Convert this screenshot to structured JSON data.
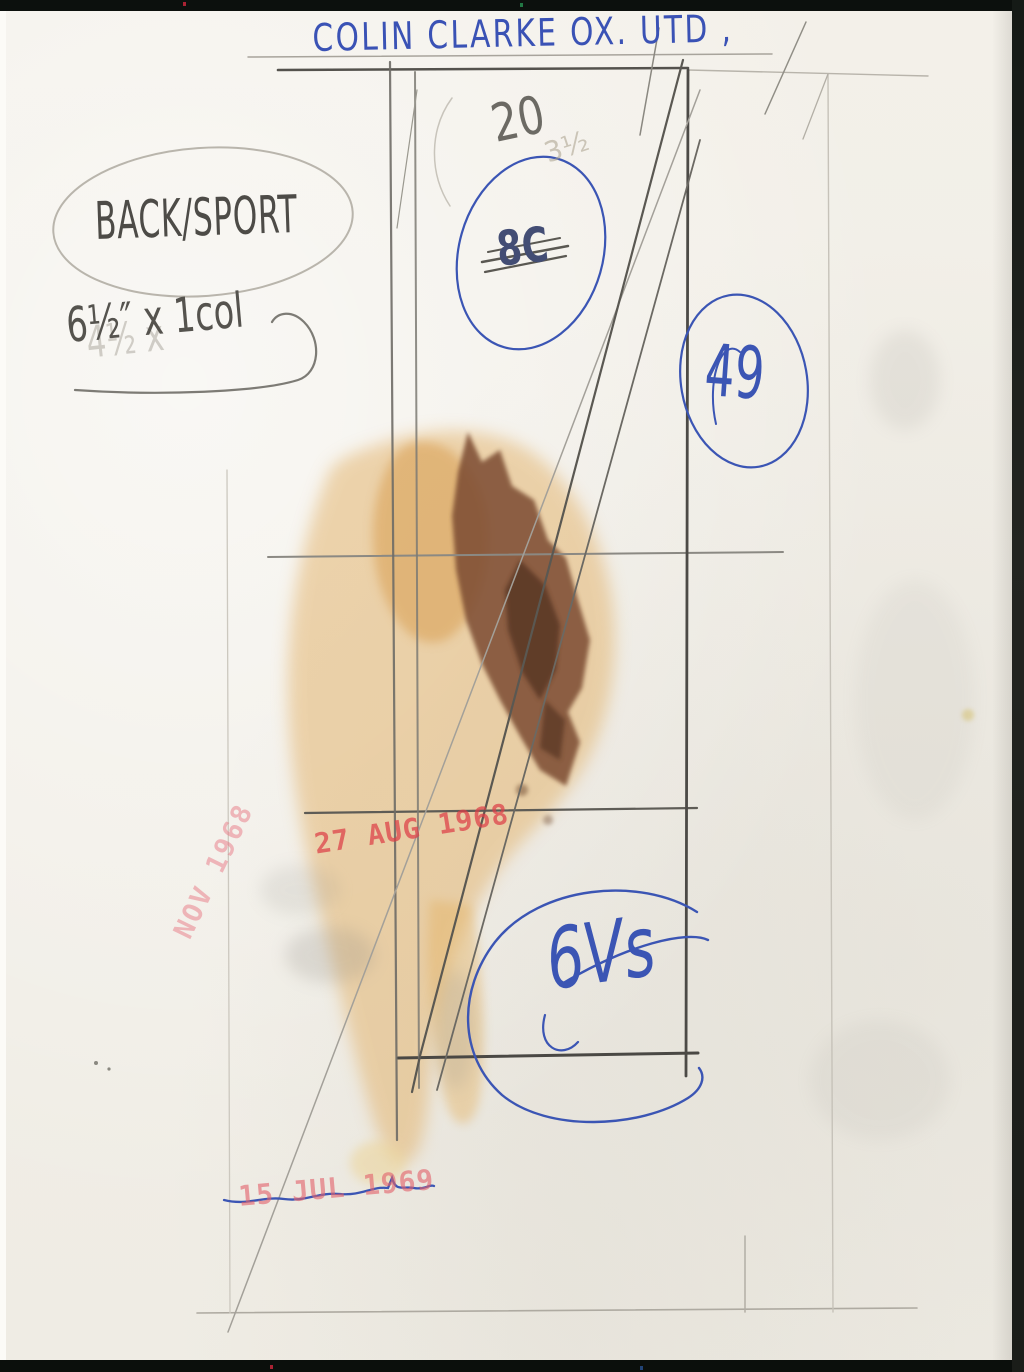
{
  "document": {
    "kind_note": "back of press photograph",
    "caption": "COLIN CLARKE OX. UTD ,",
    "section_note": "BACK/SPORT",
    "size_note": "6½″ x 1col",
    "size_note_ghost": "4½ x",
    "page_number": "20",
    "page_number_faint": "3½",
    "crossed_out_mark": "8C",
    "circled_mark": "49",
    "initials_scribble": "6Vs",
    "stamps": {
      "vertical_stamp": "NOV 1968",
      "middle_stamp": "27 AUG 1968",
      "bottom_stamp": "15 JUL 1969"
    },
    "colors": {
      "ink_blue": "#3b55b4",
      "stamp_red": "#e0484e",
      "pencil_dark": "#54524d",
      "pencil_light": "#b5b1a8",
      "paper": "#f2efe8",
      "stain_tan": "#e2b066",
      "stain_orange": "#d79a48",
      "stain_brown": "#7c4c30",
      "photo_edge": "#0c100d"
    }
  }
}
